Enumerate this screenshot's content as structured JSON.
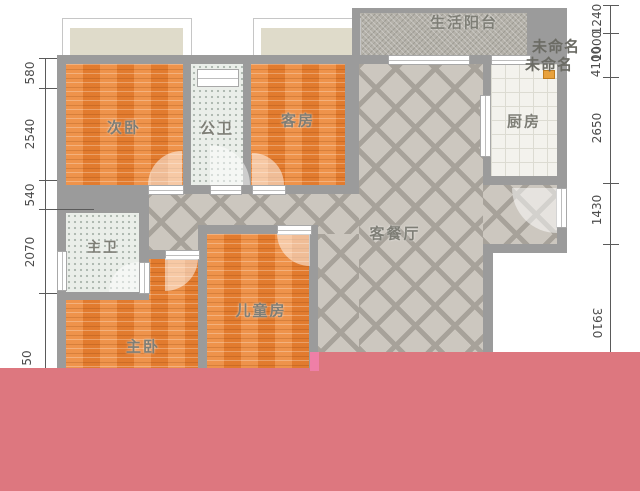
{
  "plan": {
    "rooms": {
      "balcony": "生活阳台",
      "unnamed_1": "未命名",
      "unnamed_2": "未命名",
      "secondary_bedroom": "次卧",
      "public_bathroom": "公卫",
      "guest_room": "客房",
      "kitchen": "厨房",
      "living_dining": "客餐厅",
      "master_bathroom": "主卫",
      "master_bedroom": "主卧",
      "children_room": "儿童房"
    },
    "dimensions": {
      "left": {
        "s1": "580",
        "s2": "2540",
        "s3": "540",
        "s4": "2070",
        "s5": "50"
      },
      "right": {
        "s1": "1240",
        "s2": "1000",
        "s3": "4100",
        "s4": "2650",
        "s5": "1430",
        "s6": "3910"
      }
    },
    "colors": {
      "wall": "#9b9b9b",
      "wood_floor": "#ea8336",
      "hall_tile": "#ccc7bf",
      "censor_pink": "#dd777f",
      "censor_magenta": "#ef7fa7"
    }
  }
}
